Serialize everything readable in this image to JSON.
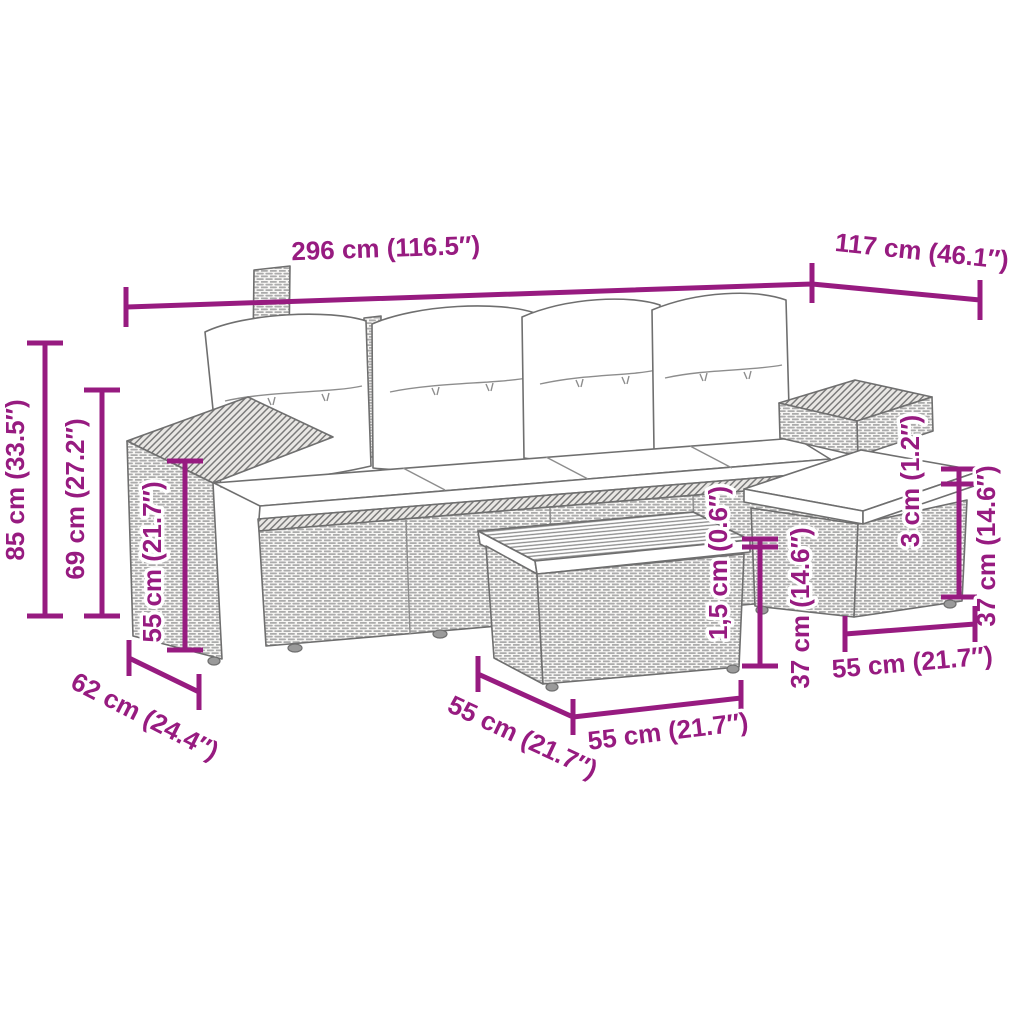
{
  "colors": {
    "dimension_accent": "#971b80",
    "line_art": "#6f6f6f",
    "background": "#ffffff"
  },
  "dimensions": {
    "overall_width": "296 cm (116.5″)",
    "overall_depth": "117 cm (46.1″)",
    "total_height": "85 cm (33.5″)",
    "back_height": "69 cm (27.2″)",
    "armrest_height": "55 cm (21.7″)",
    "sofa_depth": "62 cm (24.4″)",
    "table_side_width": "55 cm (21.7″)",
    "table_front_width": "55 cm (21.7″)",
    "tabletop_thickness": "1,5 cm (0.6″)",
    "table_height": "37 cm (14.6″)",
    "stool_cushion_thickness": "3 cm (1.2″)",
    "stool_height": "37 cm (14.6″)",
    "stool_width": "55 cm (21.7″)"
  }
}
